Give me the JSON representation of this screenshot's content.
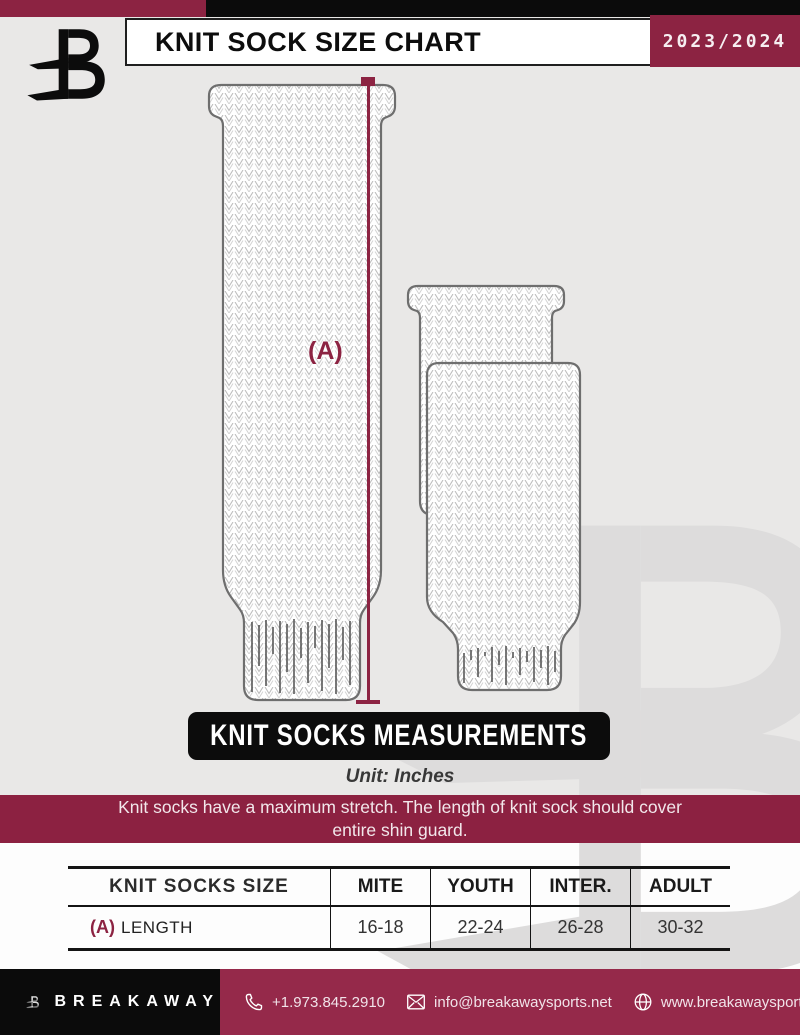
{
  "header": {
    "title": "KNIT SOCK SIZE CHART",
    "season": "2023/2024"
  },
  "diagram": {
    "measure_label": "(A)"
  },
  "measurements_banner": {
    "title": "KNIT SOCKS MEASUREMENTS",
    "unit": "Unit: Inches"
  },
  "notice": {
    "line1": "Knit socks have a maximum stretch. The length of knit sock should cover",
    "line2": "entire shin guard."
  },
  "size_table": {
    "row_header": "KNIT SOCKS SIZE",
    "columns": [
      "MITE",
      "YOUTH",
      "INTER.",
      "ADULT"
    ],
    "row": {
      "label_prefix": "(A)",
      "label": "LENGTH",
      "values": [
        "16-18",
        "22-24",
        "26-28",
        "30-32"
      ]
    }
  },
  "footer": {
    "brand": "BREAKAWAY",
    "phone": "+1.973.845.2910",
    "email": "info@breakawaysports.net",
    "website": "www.breakawaysports.net"
  },
  "colors": {
    "maroon": "#8C2342",
    "footer_maroon": "#95294A",
    "black": "#0B0B0B",
    "page_bg": "#E9E8E7",
    "watermark": "#DDDCDC"
  }
}
